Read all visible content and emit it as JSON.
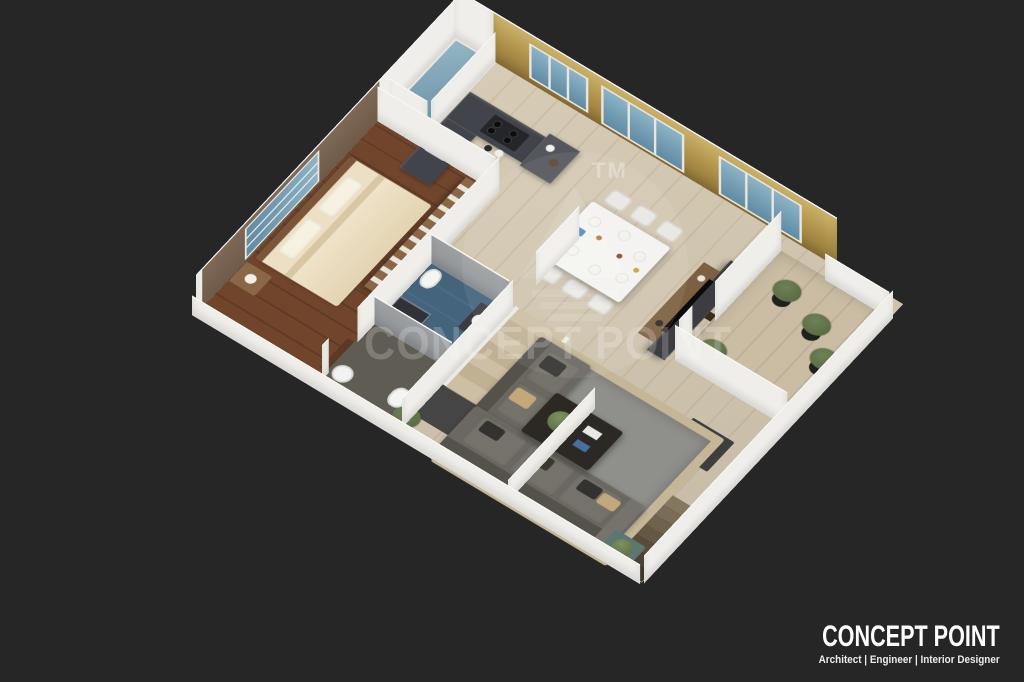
{
  "palette": {
    "bg": "#262626",
    "floor": "#d5c9b2",
    "balcony_floor": "#cabda4",
    "bedroom_floor": "#70452c",
    "bedroom_wall": "#6e5a48",
    "feature_wall": "#b3954e",
    "feature_wall_deep": "#8f7436",
    "wall": "#efeeea",
    "glass": "#8db3c6",
    "glass_deep": "#5f8ba3",
    "counter": "#41454b",
    "counter_dark": "#24262a",
    "cabinet": "#53565c",
    "wood": "#8a6847",
    "bed": "#ecdfc3",
    "bed_fold": "#d9c7a3",
    "rug": "#8f8f8b",
    "rug_border": "#c4b696",
    "sofa": "#6b6862",
    "sofa_back": "#55524c",
    "cushion_dark": "#34322e",
    "pillow_tan": "#c2a87a",
    "table": "#f4f3f0",
    "chair": "#e9e7e2",
    "bath_floor": "#44637c",
    "bath_wall": "#8f9295",
    "bath2_floor": "#5f5c53",
    "stair_beige": "#cdbfa4",
    "stair_beige_alt": "#c0b193",
    "void": "#171717",
    "landing": "#454545",
    "mat": "#3e3e3e",
    "plant": "#6e8157",
    "plant_deep": "#55663f",
    "pot": "#20201f",
    "tv_panel": "#3c3d41",
    "tv_screen": "#0b0b0b",
    "teal_table": "#5c7672",
    "door_wood": "#5a3a24",
    "watermark": "rgba(255,255,255,0.20)",
    "brand_text": "#ffffff"
  },
  "watermark": {
    "tm": "TM",
    "text": "CONCEPT POINT"
  },
  "brand": {
    "name": "CONCEPT POINT",
    "tagline": "Architect | Engineer | Interior Designer"
  },
  "scene": {
    "type": "3d-floor-plan-render",
    "view": "isometric cutaway of a one-bedroom apartment, dark studio background",
    "rooms": [
      {
        "name": "bedroom",
        "items": [
          "double bed",
          "wardrobe",
          "nightstand",
          "window",
          "wood floor"
        ]
      },
      {
        "name": "kitchen",
        "items": [
          "l-shaped counter",
          "sink",
          "hob",
          "tall cabinet",
          "window"
        ]
      },
      {
        "name": "dining-area",
        "items": [
          "white dining table",
          "six chairs",
          "table setting"
        ]
      },
      {
        "name": "living-room",
        "items": [
          "l-shaped gray sofa",
          "area rug",
          "coffee table",
          "tv console",
          "side table",
          "floor plant"
        ]
      },
      {
        "name": "bathroom",
        "items": [
          "toilet",
          "vanity",
          "shower",
          "blue tile floor"
        ]
      },
      {
        "name": "toilet",
        "items": [
          "toilet",
          "washbasin"
        ]
      },
      {
        "name": "balcony",
        "items": [
          "potted plants",
          "glass railing",
          "parapet walls"
        ]
      },
      {
        "name": "stair-hall",
        "items": [
          "staircase up",
          "staircase down",
          "doormat",
          "landing"
        ]
      }
    ]
  }
}
